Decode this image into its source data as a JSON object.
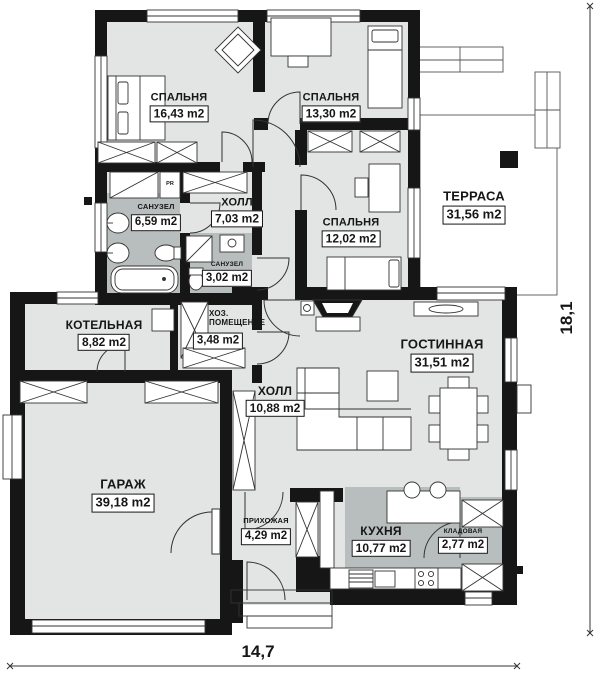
{
  "plan": {
    "rooms": [
      {
        "id": "bedroom-1",
        "name": "СПАЛЬНЯ",
        "area": "16,43 m2"
      },
      {
        "id": "bedroom-2",
        "name": "СПАЛЬНЯ",
        "area": "13,30 m2"
      },
      {
        "id": "terrace",
        "name": "ТЕРРАСА",
        "area": "31,56 m2"
      },
      {
        "id": "hall-small",
        "name": "ХОЛЛ",
        "area": "7,03 m2"
      },
      {
        "id": "bathroom-big",
        "name": "САНУЗЕЛ",
        "area": "6,59 m2"
      },
      {
        "id": "bedroom-3",
        "name": "СПАЛЬНЯ",
        "area": "12,02 m2"
      },
      {
        "id": "bathroom-small",
        "name": "САНУЗЕЛ",
        "area": "3,02 m2"
      },
      {
        "id": "boiler-room",
        "name": "КОТЕЛЬНАЯ",
        "area": "8,82 m2"
      },
      {
        "id": "utility-room",
        "name": "ХОЗ. ПОМЕЩЕНИЕ",
        "area": "3,48 m2"
      },
      {
        "id": "living-room",
        "name": "ГОСТИННАЯ",
        "area": "31,51 m2"
      },
      {
        "id": "hall-big",
        "name": "ХОЛЛ",
        "area": "10,88 m2"
      },
      {
        "id": "garage",
        "name": "ГАРАЖ",
        "area": "39,18 m2"
      },
      {
        "id": "entryway",
        "name": "ПРИХОЖАЯ",
        "area": "4,29 m2"
      },
      {
        "id": "kitchen",
        "name": "КУХНЯ",
        "area": "10,77 m2"
      },
      {
        "id": "pantry",
        "name": "КЛАДОВАЯ",
        "area": "2,77 m2"
      }
    ],
    "closet_label": "PR",
    "dimensions": {
      "width_m": "14,7",
      "height_m": "18,1"
    },
    "colors": {
      "wall": "#161616",
      "floor": "#e2e5e4",
      "wet_zone": "#b7bebd",
      "line": "#333333"
    }
  }
}
